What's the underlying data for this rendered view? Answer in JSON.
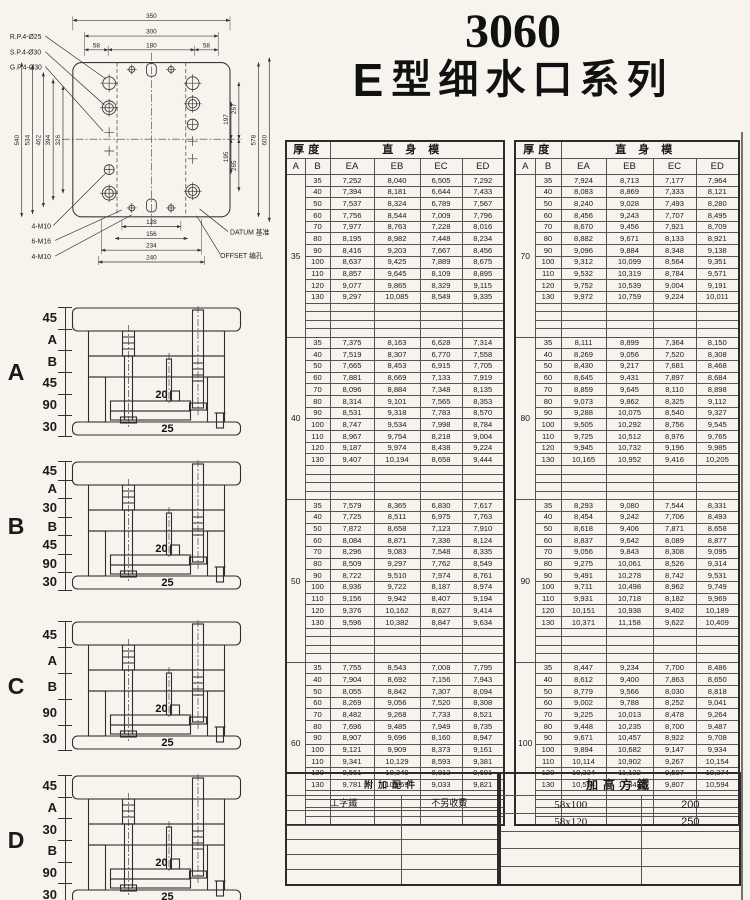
{
  "title": {
    "model": "3060",
    "series_e": "E",
    "series_name": "型细水口系列"
  },
  "drawing": {
    "top_dims": [
      "350",
      "300",
      "58",
      "180",
      "58"
    ],
    "left_dims": [
      "540",
      "534",
      "462",
      "394",
      "326"
    ],
    "right_outer_dims": [
      "578",
      "600"
    ],
    "right_inner_dims": [
      "267",
      "197",
      "195",
      "265"
    ],
    "bottom_dims": [
      "128",
      "156",
      "234",
      "240"
    ],
    "callouts_left_top": [
      "R.P.4-Ø25",
      "S.P.4-Ø30",
      "G.P.4-Ø30"
    ],
    "callouts_left_bottom": [
      "4-M10",
      "6-M16",
      "4-M10"
    ],
    "callout_datum": "DATUM 基准",
    "callout_offset": "OFFSET 编孔"
  },
  "price_header": {
    "thickness": "厚度",
    "straight": "直身模",
    "col_a": "A",
    "col_b": "B",
    "cols": [
      "EA",
      "EB",
      "EC",
      "ED"
    ]
  },
  "left_blocks": [
    {
      "A": "35",
      "rows": [
        [
          "35",
          "7,252",
          "8,040",
          "6,505",
          "7,292"
        ],
        [
          "40",
          "7,394",
          "8,181",
          "6,644",
          "7,433"
        ],
        [
          "50",
          "7,537",
          "8,324",
          "6,789",
          "7,567"
        ],
        [
          "60",
          "7,756",
          "8,544",
          "7,009",
          "7,796"
        ],
        [
          "70",
          "7,977",
          "8,763",
          "7,228",
          "8,016"
        ],
        [
          "80",
          "8,195",
          "8,982",
          "7,448",
          "8,234"
        ],
        [
          "90",
          "8,416",
          "9,203",
          "7,667",
          "8,456"
        ],
        [
          "100",
          "8,637",
          "9,425",
          "7,889",
          "8,675"
        ],
        [
          "110",
          "8,857",
          "9,645",
          "8,109",
          "8,895"
        ],
        [
          "120",
          "9,077",
          "9,865",
          "8,329",
          "9,115"
        ],
        [
          "130",
          "9,297",
          "10,085",
          "8,549",
          "9,335"
        ]
      ]
    },
    {
      "A": "40",
      "rows": [
        [
          "35",
          "7,375",
          "8,163",
          "6,628",
          "7,314"
        ],
        [
          "40",
          "7,519",
          "8,307",
          "6,770",
          "7,558"
        ],
        [
          "50",
          "7,665",
          "8,453",
          "6,915",
          "7,705"
        ],
        [
          "60",
          "7,881",
          "8,669",
          "7,133",
          "7,919"
        ],
        [
          "70",
          "8,096",
          "8,884",
          "7,348",
          "8,135"
        ],
        [
          "80",
          "8,314",
          "9,101",
          "7,565",
          "8,353"
        ],
        [
          "90",
          "8,531",
          "9,318",
          "7,783",
          "8,570"
        ],
        [
          "100",
          "8,747",
          "9,534",
          "7,998",
          "8,784"
        ],
        [
          "110",
          "8,967",
          "9,754",
          "8,218",
          "9,004"
        ],
        [
          "120",
          "9,187",
          "9,974",
          "8,438",
          "9,224"
        ],
        [
          "130",
          "9,407",
          "10,194",
          "8,658",
          "9,444"
        ]
      ]
    },
    {
      "A": "50",
      "rows": [
        [
          "35",
          "7,579",
          "8,365",
          "6,830",
          "7,617"
        ],
        [
          "40",
          "7,725",
          "8,511",
          "6,975",
          "7,763"
        ],
        [
          "50",
          "7,872",
          "8,658",
          "7,123",
          "7,910"
        ],
        [
          "60",
          "8,084",
          "8,871",
          "7,336",
          "8,124"
        ],
        [
          "70",
          "8,296",
          "9,083",
          "7,548",
          "8,335"
        ],
        [
          "80",
          "8,509",
          "9,297",
          "7,762",
          "8,549"
        ],
        [
          "90",
          "8,722",
          "9,510",
          "7,974",
          "8,761"
        ],
        [
          "100",
          "8,936",
          "9,722",
          "8,187",
          "8,974"
        ],
        [
          "110",
          "9,156",
          "9,942",
          "8,407",
          "9,194"
        ],
        [
          "120",
          "9,376",
          "10,162",
          "8,627",
          "9,414"
        ],
        [
          "130",
          "9,596",
          "10,382",
          "8,847",
          "9,634"
        ]
      ]
    },
    {
      "A": "60",
      "rows": [
        [
          "35",
          "7,755",
          "8,543",
          "7,008",
          "7,795"
        ],
        [
          "40",
          "7,904",
          "8,692",
          "7,156",
          "7,943"
        ],
        [
          "50",
          "8,055",
          "8,842",
          "7,307",
          "8,094"
        ],
        [
          "60",
          "8,269",
          "9,056",
          "7,520",
          "8,308"
        ],
        [
          "70",
          "8,482",
          "9,268",
          "7,733",
          "8,521"
        ],
        [
          "80",
          "7,696",
          "9,485",
          "7,949",
          "8,735"
        ],
        [
          "90",
          "8,907",
          "9,696",
          "8,160",
          "8,947"
        ],
        [
          "100",
          "9,121",
          "9,909",
          "8,373",
          "9,161"
        ],
        [
          "110",
          "9,341",
          "10,129",
          "8,593",
          "9,381"
        ],
        [
          "120",
          "9,561",
          "10,349",
          "8,813",
          "9,601"
        ],
        [
          "130",
          "9,781",
          "10,569",
          "9,033",
          "9,821"
        ]
      ]
    }
  ],
  "right_blocks": [
    {
      "A": "70",
      "rows": [
        [
          "35",
          "7,924",
          "8,713",
          "7,177",
          "7,964"
        ],
        [
          "40",
          "8,083",
          "8,869",
          "7,333",
          "8,121"
        ],
        [
          "50",
          "8,240",
          "9,028",
          "7,493",
          "8,280"
        ],
        [
          "60",
          "8,456",
          "9,243",
          "7,707",
          "8,495"
        ],
        [
          "70",
          "8,670",
          "9,456",
          "7,921",
          "8,709"
        ],
        [
          "80",
          "8,882",
          "9,671",
          "8,133",
          "8,921"
        ],
        [
          "90",
          "9,096",
          "9,884",
          "8,348",
          "9,138"
        ],
        [
          "100",
          "9,312",
          "10,099",
          "8,564",
          "9,351"
        ],
        [
          "110",
          "9,532",
          "10,319",
          "8,784",
          "9,571"
        ],
        [
          "120",
          "9,752",
          "10,539",
          "9,004",
          "9,191"
        ],
        [
          "130",
          "9,972",
          "10,759",
          "9,224",
          "10,011"
        ]
      ]
    },
    {
      "A": "80",
      "rows": [
        [
          "35",
          "8,111",
          "8,899",
          "7,364",
          "8,150"
        ],
        [
          "40",
          "8,269",
          "9,056",
          "7,520",
          "8,308"
        ],
        [
          "50",
          "8,430",
          "9,217",
          "7,681",
          "8,468"
        ],
        [
          "60",
          "8,645",
          "9,431",
          "7,897",
          "8,684"
        ],
        [
          "70",
          "8,859",
          "9,645",
          "8,110",
          "8,898"
        ],
        [
          "80",
          "9,073",
          "9,862",
          "8,325",
          "9,112"
        ],
        [
          "90",
          "9,288",
          "10,075",
          "8,540",
          "9,327"
        ],
        [
          "100",
          "9,505",
          "10,292",
          "8,756",
          "9,545"
        ],
        [
          "110",
          "9,725",
          "10,512",
          "8,976",
          "9,765"
        ],
        [
          "120",
          "9,945",
          "10,732",
          "9,196",
          "9,985"
        ],
        [
          "130",
          "10,165",
          "10,952",
          "9,416",
          "10,205"
        ]
      ]
    },
    {
      "A": "90",
      "rows": [
        [
          "35",
          "8,293",
          "9,080",
          "7,544",
          "8,331"
        ],
        [
          "40",
          "8,454",
          "9,242",
          "7,706",
          "8,493"
        ],
        [
          "50",
          "8,618",
          "9,406",
          "7,871",
          "8,658"
        ],
        [
          "60",
          "8,837",
          "9,642",
          "8,089",
          "8,877"
        ],
        [
          "70",
          "9,056",
          "9,843",
          "8,308",
          "9,095"
        ],
        [
          "80",
          "9,275",
          "10,061",
          "8,526",
          "9,314"
        ],
        [
          "90",
          "9,491",
          "10,278",
          "8,742",
          "9,531"
        ],
        [
          "100",
          "9,711",
          "10,498",
          "8,962",
          "9,749"
        ],
        [
          "110",
          "9,931",
          "10,718",
          "8,182",
          "9,969"
        ],
        [
          "120",
          "10,151",
          "10,938",
          "9,402",
          "10,189"
        ],
        [
          "130",
          "10,371",
          "11,158",
          "9,622",
          "10,409"
        ]
      ]
    },
    {
      "A": "100",
      "rows": [
        [
          "35",
          "8,447",
          "9,234",
          "7,700",
          "8,486"
        ],
        [
          "40",
          "8,612",
          "9,400",
          "7,863",
          "8,650"
        ],
        [
          "50",
          "8,779",
          "9,566",
          "8,030",
          "8,818"
        ],
        [
          "60",
          "9,002",
          "9,788",
          "8,252",
          "9,041"
        ],
        [
          "70",
          "9,225",
          "10,013",
          "8,478",
          "9,264"
        ],
        [
          "80",
          "9,448",
          "10,235",
          "8,700",
          "9,487"
        ],
        [
          "90",
          "9,671",
          "10,457",
          "8,922",
          "9,708"
        ],
        [
          "100",
          "9,894",
          "10,682",
          "9,147",
          "9,934"
        ],
        [
          "110",
          "10,114",
          "10,902",
          "9,267",
          "10,154"
        ],
        [
          "120",
          "10,334",
          "11,122",
          "9,587",
          "10,374"
        ],
        [
          "130",
          "10,554",
          "11,342",
          "9,807",
          "10,594"
        ]
      ]
    }
  ],
  "diagrams": [
    {
      "letter": "A",
      "dims": [
        "45",
        "A",
        "B",
        "45",
        "90",
        "30"
      ],
      "pin_dim": "20",
      "ej_dim": "25"
    },
    {
      "letter": "B",
      "dims": [
        "45",
        "A",
        "30",
        "B",
        "45",
        "90",
        "30"
      ],
      "pin_dim": "20",
      "ej_dim": "25"
    },
    {
      "letter": "C",
      "dims": [
        "45",
        "A",
        "B",
        "90",
        "30"
      ],
      "pin_dim": "20",
      "ej_dim": "25"
    },
    {
      "letter": "D",
      "dims": [
        "45",
        "A",
        "30",
        "B",
        "90",
        "30"
      ],
      "pin_dim": "20",
      "ej_dim": "25"
    }
  ],
  "accessories": {
    "left_title": "附加配件",
    "right_title": "加高方鐵",
    "left_rows": [
      [
        "工字鐵",
        "不另收費"
      ],
      [
        "",
        ""
      ],
      [
        "",
        ""
      ],
      [
        "",
        ""
      ],
      [
        "",
        ""
      ],
      [
        "",
        ""
      ]
    ],
    "right_rows": [
      [
        "58x100",
        "200"
      ],
      [
        "58x120",
        "250"
      ],
      [
        "",
        ""
      ],
      [
        "",
        ""
      ],
      [
        "",
        ""
      ]
    ]
  }
}
